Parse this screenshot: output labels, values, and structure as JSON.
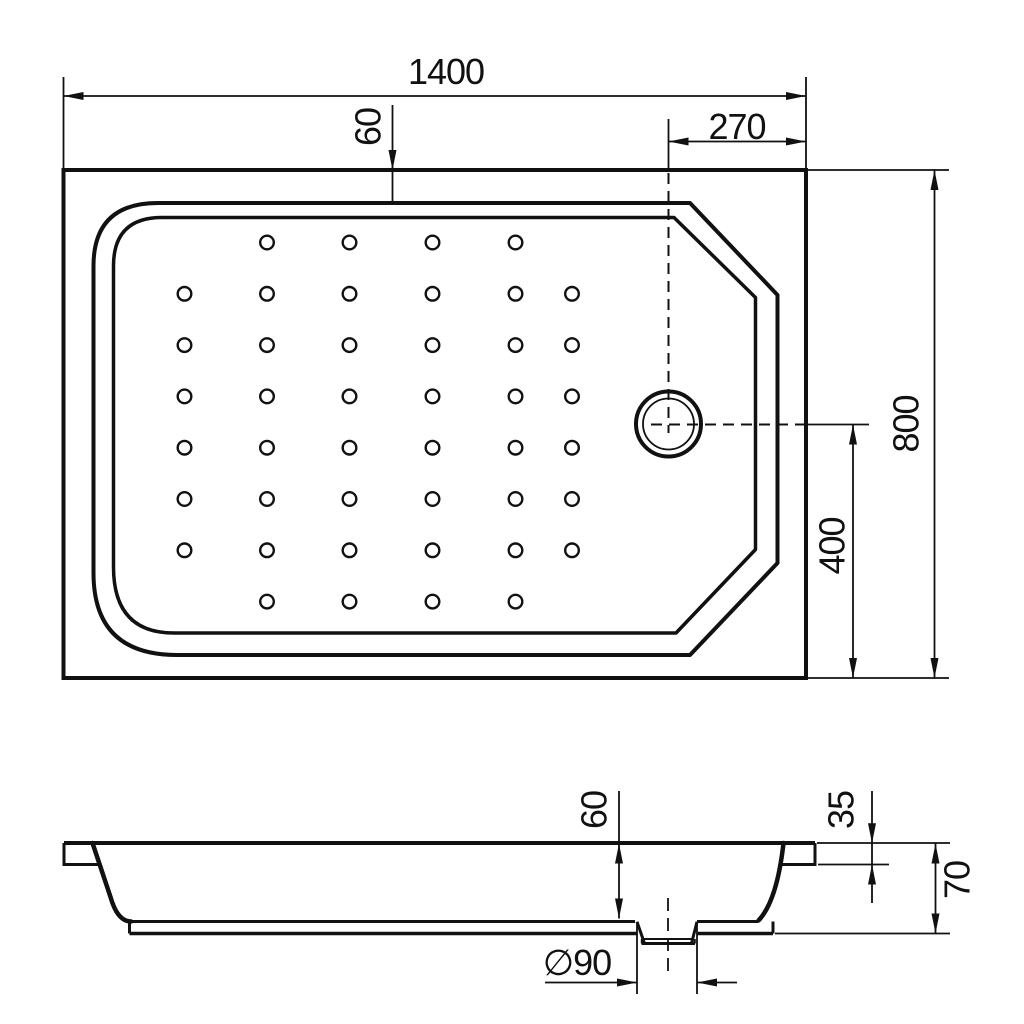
{
  "meta": {
    "type": "technical-drawing",
    "subject": "rectangular shower tray with drain",
    "views": [
      "plan",
      "section"
    ]
  },
  "colors": {
    "line": "#111111",
    "background": "#ffffff"
  },
  "top_view": {
    "dimensions": {
      "overall_width": "1400",
      "basin_top_offset": "60",
      "drain_to_right_edge": "270",
      "overall_depth": "800",
      "drain_to_bottom_edge": "400"
    },
    "dot_grid": {
      "cols": [
        184.5,
        267,
        349.5,
        432.5,
        515.5,
        572
      ],
      "rows": [
        242.5,
        293.8,
        345.1,
        396.4,
        447.7,
        499,
        550.3,
        601.6
      ],
      "short_row_indices": [
        0,
        7
      ],
      "short_row_col_indices": [
        1,
        2,
        3,
        4
      ],
      "radius": 6.8
    },
    "drain": {
      "center_x": 668.5,
      "center_y": 424,
      "outer_radius": 32.5,
      "inner_radius": 25.5
    }
  },
  "side_view": {
    "dimensions": {
      "basin_depth": "60",
      "rim_height": "35",
      "total_height": "70",
      "drain_diameter": "∅90"
    }
  }
}
